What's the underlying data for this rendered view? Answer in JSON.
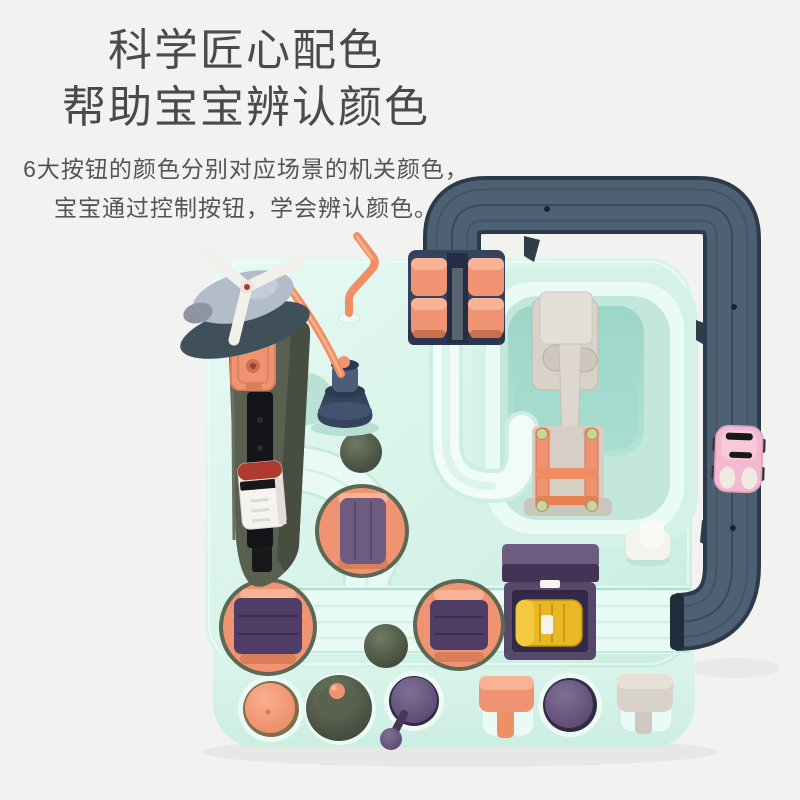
{
  "heading": {
    "line1": "科学匠心配色",
    "line2": "帮助宝宝辨认颜色"
  },
  "subheading": {
    "line1": "6大按钮的颜色分别对应场景的机关颜色，",
    "line2": "宝宝通过控制按钮，学会辨认颜色。"
  },
  "colors": {
    "bg": "#f2f2f1",
    "text_primary": "#4a4a4a",
    "text_secondary": "#545454",
    "mint_base": "#d5f1e8",
    "mint_light": "#e9fbf4",
    "mint_dark": "#c3e8db",
    "pool": "#a7ddd0",
    "track": "#4e6073",
    "track_dark": "#2c3b49",
    "salmon": "#f09372",
    "salmon_light": "#f8b294",
    "navy": "#36435c",
    "olive": "#59604f",
    "olive_ball": "#4d5547",
    "purple": "#4e3d64",
    "purple_light": "#6d5c80",
    "yellow": "#e9b822",
    "pink": "#f2b9d0",
    "cream": "#f5f3ee",
    "beige": "#d8d2c9",
    "gray_lever": "#d9d2c8"
  }
}
